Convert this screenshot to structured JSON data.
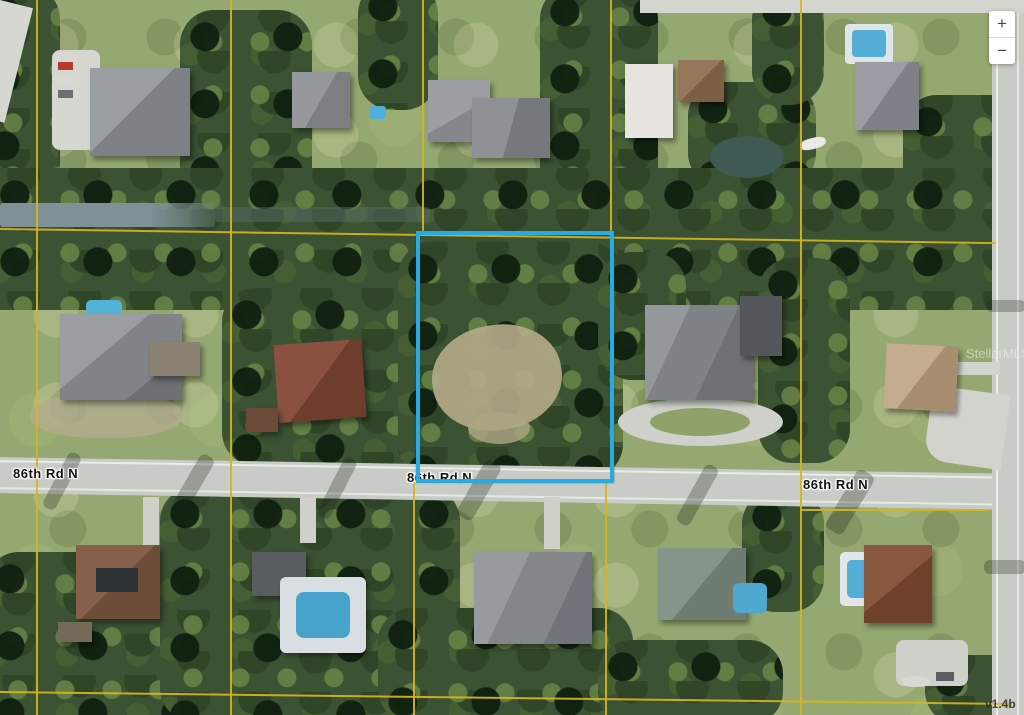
{
  "map": {
    "road_labels": [
      {
        "text": "86th Rd N"
      },
      {
        "text": "86th Rd N"
      },
      {
        "text": "86th Rd N"
      }
    ],
    "watermark": "StellarMLS",
    "version_tag": "v1.4b",
    "zoom_control": {
      "zoom_in": "+",
      "zoom_out": "−"
    },
    "colors": {
      "parcel_highlight": "#29ABE2",
      "parcel_grid": "#D9B321"
    }
  }
}
